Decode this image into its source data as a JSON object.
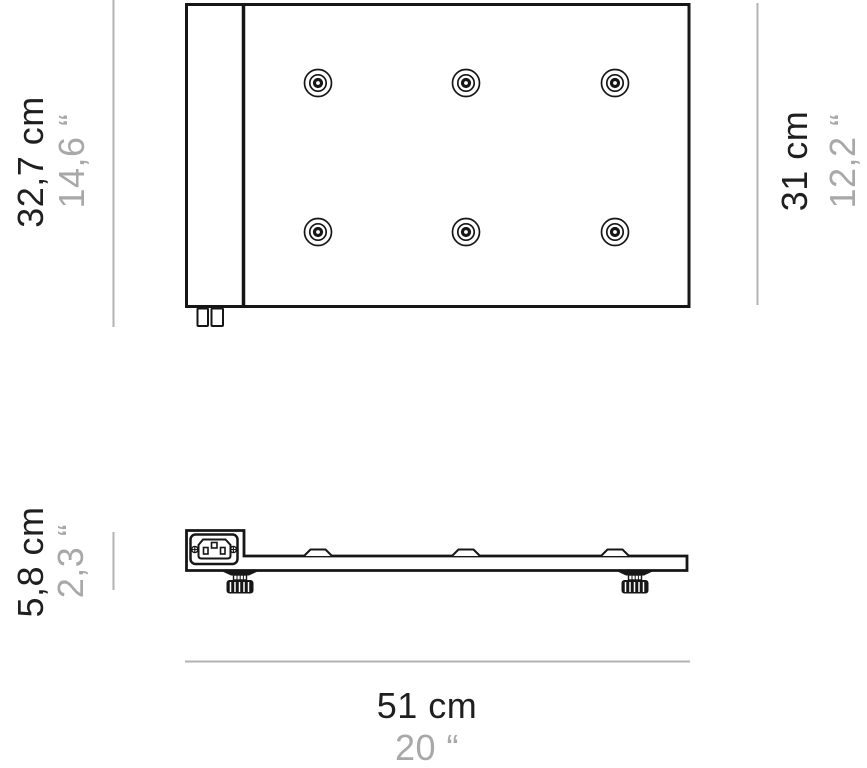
{
  "diagram": {
    "type": "technical-dimension-drawing",
    "views": [
      "top-view",
      "side-view"
    ],
    "mount_points": 6,
    "colors": {
      "outline": "#161616",
      "dimension_line": "#b3b3b3",
      "metric_label": "#1f1f1f",
      "imperial_label": "#a8a8a8",
      "background": "#ffffff"
    }
  },
  "labels": {
    "depth_total_cm": "32,7 cm",
    "depth_total_in": "14,6 “",
    "depth_panel_cm": "31 cm",
    "depth_panel_in": "12,2 “",
    "height_cm": "5,8 cm",
    "height_in": "2,3 “",
    "width_cm": "51 cm",
    "width_in": "20 “"
  }
}
